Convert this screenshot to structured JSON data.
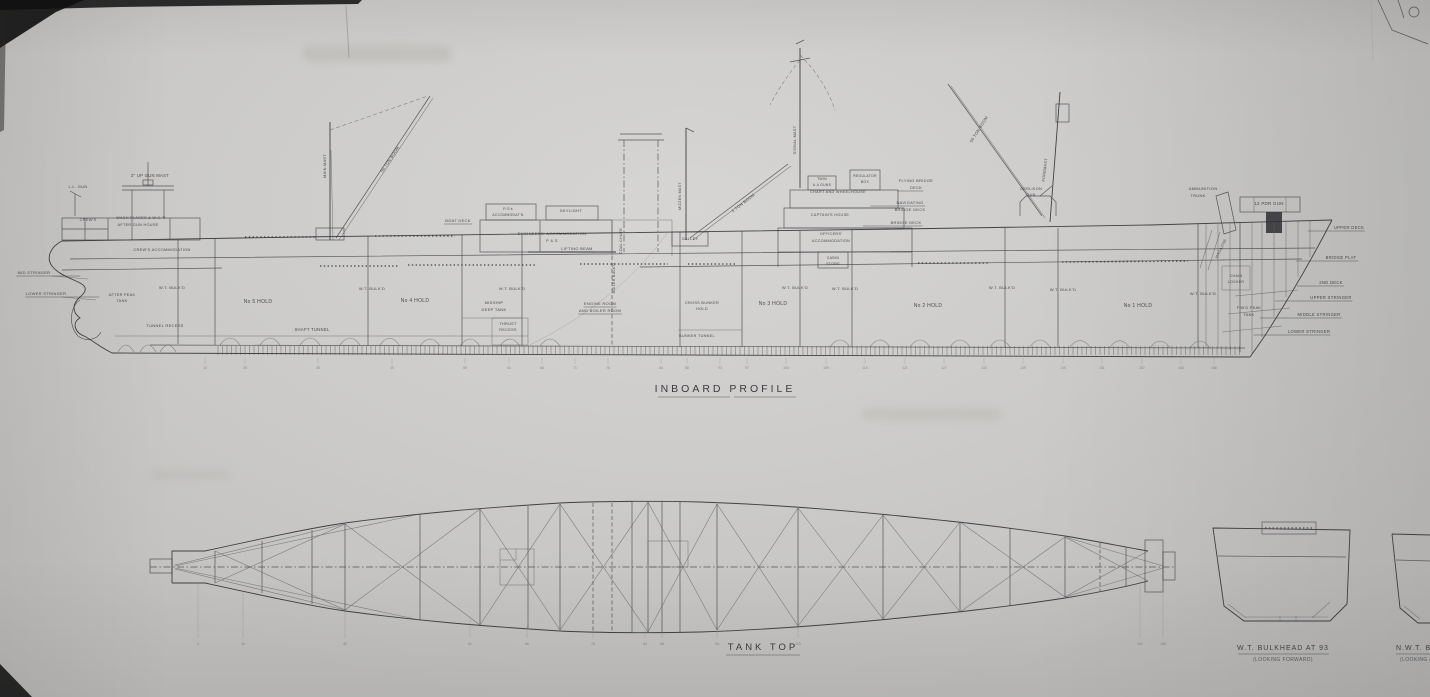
{
  "drawing": {
    "profile_title": "INBOARD PROFILE",
    "tank_top_title": "TANK TOP",
    "bulkhead1_caption": "W.T. BULKHEAD AT 93",
    "bulkhead1_sub": "(LOOKING FORWARD)",
    "bulkhead2_caption": "N.W.T. BULKHEAD",
    "bulkhead2_sub": "(LOOKING FORWARD)"
  },
  "colors": {
    "paper": "#c9c8c5",
    "ink": "#34343a",
    "ink_faint": "#55555a"
  },
  "labels": [
    {
      "n": "ll-gun",
      "t": "L.L. GUN",
      "x": 78,
      "y": 188,
      "s": 4
    },
    {
      "n": "up-gun-mast",
      "t": "2\" UP GUN MAST",
      "x": 150,
      "y": 177,
      "s": 4.2
    },
    {
      "n": "crews",
      "t": "CREW'S",
      "x": 88,
      "y": 221,
      "s": 3.8
    },
    {
      "n": "wash-places",
      "t": "WASH PLACES & W.C.'S",
      "x": 141,
      "y": 219,
      "s": 3.8
    },
    {
      "n": "after-gun-house",
      "t": "AFTER GUN HOUSE",
      "x": 138,
      "y": 226,
      "s": 3.8
    },
    {
      "n": "crews-accommodation",
      "t": "CREW'S ACCOMMODATION",
      "x": 162,
      "y": 251,
      "s": 3.9
    },
    {
      "n": "mid-stringer-aft",
      "t": "MID STRINGER",
      "x": 34,
      "y": 274,
      "s": 4,
      "ul": true,
      "lead": "right"
    },
    {
      "n": "lower-stringer-aft",
      "t": "LOWER STRINGER",
      "x": 46,
      "y": 295,
      "s": 4,
      "ul": true,
      "lead": "right"
    },
    {
      "n": "after-peak-tank-1",
      "t": "AFTER PEAK",
      "x": 122,
      "y": 296,
      "s": 3.8
    },
    {
      "n": "after-peak-tank-2",
      "t": "TANK",
      "x": 122,
      "y": 302,
      "s": 3.8
    },
    {
      "n": "tunnel-recess",
      "t": "TUNNEL RECESS",
      "x": 165,
      "y": 327,
      "s": 4
    },
    {
      "n": "wt-bulkd-0",
      "t": "W.T. BULK'D",
      "x": 172,
      "y": 289,
      "s": 4
    },
    {
      "n": "no5-hold",
      "t": "No 5 HOLD",
      "x": 258,
      "y": 303,
      "s": 5
    },
    {
      "n": "shaft-tunnel",
      "t": "SHAFT TUNNEL",
      "x": 312,
      "y": 331,
      "s": 4.2
    },
    {
      "n": "wt-bulkd-1",
      "t": "W.T. BULK'D",
      "x": 372,
      "y": 290,
      "s": 4
    },
    {
      "n": "no4-hold",
      "t": "No 4 HOLD",
      "x": 415,
      "y": 302,
      "s": 5
    },
    {
      "n": "wt-bulkd-2",
      "t": "W.T. BULK'D",
      "x": 512,
      "y": 290,
      "s": 4
    },
    {
      "n": "midship-deep-tank-1",
      "t": "MIDSHIP",
      "x": 494,
      "y": 304,
      "s": 4
    },
    {
      "n": "midship-deep-tank-2",
      "t": "DEEP TANK",
      "x": 494,
      "y": 311,
      "s": 4
    },
    {
      "n": "thrust-recess-1",
      "t": "THRUST",
      "x": 508,
      "y": 325,
      "s": 3.8
    },
    {
      "n": "thrust-recess-2",
      "t": "RECESS",
      "x": 508,
      "y": 331,
      "s": 3.8
    },
    {
      "n": "boat-deck",
      "t": "BOAT DECK",
      "x": 458,
      "y": 222,
      "s": 4,
      "ul": true
    },
    {
      "n": "pos-accommodation-1",
      "t": "P.O's",
      "x": 508,
      "y": 210,
      "s": 3.6
    },
    {
      "n": "pos-accommodation-2",
      "t": "ACCOMMODAT'N",
      "x": 508,
      "y": 216,
      "s": 3.4
    },
    {
      "n": "skylight",
      "t": "SKYLIGHT",
      "x": 571,
      "y": 212,
      "s": 4
    },
    {
      "n": "engineers-accommodation-1",
      "t": "ENGINEERS' ACCOMMODATION",
      "x": 552,
      "y": 235,
      "s": 4
    },
    {
      "n": "engineers-accommodation-2",
      "t": "P & S",
      "x": 552,
      "y": 242,
      "s": 4
    },
    {
      "n": "lifting-beam",
      "t": "LIFTING BEAM",
      "x": 577,
      "y": 250,
      "s": 4,
      "ul": true
    },
    {
      "n": "coal-chute",
      "t": "COAL CHUTE",
      "x": 622,
      "y": 241,
      "s": 3.6,
      "r": -90
    },
    {
      "n": "boiler-bulkd",
      "t": "BOILER BULK'D",
      "x": 615,
      "y": 278,
      "s": 3.6,
      "r": -90
    },
    {
      "n": "engine-boiler-room-1",
      "t": "ENGINE ROOM",
      "x": 600,
      "y": 305,
      "s": 4,
      "ul": true
    },
    {
      "n": "engine-boiler-room-2",
      "t": "AND BOILER ROOM",
      "x": 600,
      "y": 312,
      "s": 4,
      "ul": true
    },
    {
      "n": "bunker-tunnel",
      "t": "BUNKER TUNNEL",
      "x": 697,
      "y": 337,
      "s": 3.8
    },
    {
      "n": "cross-bunker-hold-1",
      "t": "CROSS BUNKER",
      "x": 702,
      "y": 304,
      "s": 3.8
    },
    {
      "n": "cross-bunker-hold-2",
      "t": "HOLD",
      "x": 702,
      "y": 310,
      "s": 3.8
    },
    {
      "n": "galley",
      "t": "GALLEY",
      "x": 690,
      "y": 240,
      "s": 3.8
    },
    {
      "n": "mizzen-mast",
      "t": "MIZZEN MAST",
      "x": 681,
      "y": 196,
      "s": 3.6,
      "r": -90
    },
    {
      "n": "five-ton-boom",
      "t": "5 TON BOOM",
      "x": 744,
      "y": 204,
      "s": 4,
      "r": -38
    },
    {
      "n": "signal-mast",
      "t": "SIGNAL MAST",
      "x": 796,
      "y": 140,
      "s": 3.8,
      "r": -90
    },
    {
      "n": "twin-aa-guns-1",
      "t": "TWIN",
      "x": 822,
      "y": 180,
      "s": 3.4
    },
    {
      "n": "twin-aa-guns-2",
      "t": "A.A GUNS",
      "x": 822,
      "y": 186,
      "s": 3.4
    },
    {
      "n": "regulator-box-1",
      "t": "REGULATOR",
      "x": 865,
      "y": 177,
      "s": 3.4
    },
    {
      "n": "regulator-box-2",
      "t": "BOX",
      "x": 865,
      "y": 183,
      "s": 3.4
    },
    {
      "n": "flying-bridge-deck-1",
      "t": "FLYING BRIDGE",
      "x": 916,
      "y": 182,
      "s": 4
    },
    {
      "n": "flying-bridge-deck-2",
      "t": "DECK",
      "x": 916,
      "y": 189,
      "s": 4,
      "ul": true,
      "lead": "left"
    },
    {
      "n": "chart-wheelhouse",
      "t": "CHART AND WHEELHOUSE",
      "x": 838,
      "y": 193,
      "s": 3.8
    },
    {
      "n": "navigating-bridge-deck-1",
      "t": "NAVIGATING",
      "x": 910,
      "y": 204,
      "s": 4,
      "ul": true,
      "lead": "left"
    },
    {
      "n": "navigating-bridge-deck-2",
      "t": "BRIDGE DECK",
      "x": 910,
      "y": 211,
      "s": 4
    },
    {
      "n": "captains-house",
      "t": "CAPTAIN'S HOUSE",
      "x": 830,
      "y": 216,
      "s": 3.8
    },
    {
      "n": "bridge-deck",
      "t": "BRIDGE DECK",
      "x": 906,
      "y": 224,
      "s": 4,
      "ul": true,
      "lead": "left"
    },
    {
      "n": "officers-accommodation-1",
      "t": "OFFICERS'",
      "x": 831,
      "y": 235,
      "s": 3.8
    },
    {
      "n": "officers-accommodation-2",
      "t": "ACCOMMODATION",
      "x": 831,
      "y": 242,
      "s": 3.8
    },
    {
      "n": "cabin-store-1",
      "t": "CABIN",
      "x": 833,
      "y": 259,
      "s": 3.6
    },
    {
      "n": "cabin-store-2",
      "t": "STORE",
      "x": 833,
      "y": 265,
      "s": 3.6
    },
    {
      "n": "no3-hold",
      "t": "No 3 HOLD",
      "x": 773,
      "y": 305,
      "s": 5
    },
    {
      "n": "wt-bulkd-3",
      "t": "W.T. BULK'D",
      "x": 795,
      "y": 289,
      "s": 4
    },
    {
      "n": "wt-bulkd-4",
      "t": "W.T. BULK'D",
      "x": 845,
      "y": 290,
      "s": 4
    },
    {
      "n": "no2-hold",
      "t": "No 2 HOLD",
      "x": 928,
      "y": 307,
      "s": 5
    },
    {
      "n": "wt-bulkd-5",
      "t": "W.T. BULK'D",
      "x": 1002,
      "y": 289,
      "s": 4
    },
    {
      "n": "wt-bulkd-6",
      "t": "W.T. BULK'D",
      "x": 1063,
      "y": 291,
      "s": 4
    },
    {
      "n": "no1-hold",
      "t": "No 1 HOLD",
      "x": 1138,
      "y": 307,
      "s": 5
    },
    {
      "n": "wt-bulkd-7",
      "t": "W.T. BULK'D",
      "x": 1203,
      "y": 295,
      "s": 4
    },
    {
      "n": "oerlikon-gun-1",
      "t": "OERLIKON",
      "x": 1031,
      "y": 190,
      "s": 3.8
    },
    {
      "n": "oerlikon-gun-2",
      "t": "GUN",
      "x": 1031,
      "y": 196,
      "s": 3.8
    },
    {
      "n": "foremast",
      "t": "FOREMAST",
      "x": 1046,
      "y": 170,
      "s": 3.8,
      "r": -83
    },
    {
      "n": "fifty-ton-boom-main",
      "t": "50 TON BOOM",
      "x": 391,
      "y": 160,
      "s": 4,
      "r": -56
    },
    {
      "n": "fifty-ton-boom-fore",
      "t": "50 TON BOOM",
      "x": 980,
      "y": 130,
      "s": 4,
      "r": -58
    },
    {
      "n": "ammunition-trunk-1",
      "t": "AMMUNITION",
      "x": 1203,
      "y": 190,
      "s": 4
    },
    {
      "n": "ammunition-trunk-2",
      "t": "TRUNK",
      "x": 1198,
      "y": 197,
      "s": 4
    },
    {
      "n": "twelve-pdr-gun",
      "t": "12 PDR GUN",
      "x": 1269,
      "y": 205,
      "s": 4.4
    },
    {
      "n": "magazine",
      "t": "MAGAZINE",
      "x": 1222,
      "y": 249,
      "s": 3.6,
      "r": -64
    },
    {
      "n": "chain-locker-1",
      "t": "CHAIN",
      "x": 1236,
      "y": 277,
      "s": 3.6
    },
    {
      "n": "chain-locker-2",
      "t": "LOCKER",
      "x": 1236,
      "y": 283,
      "s": 3.6
    },
    {
      "n": "fwd-peak-tank-1",
      "t": "F'W'D PEAK",
      "x": 1249,
      "y": 309,
      "s": 3.8
    },
    {
      "n": "fwd-peak-tank-2",
      "t": "TANK",
      "x": 1249,
      "y": 316,
      "s": 3.8
    },
    {
      "n": "upper-deck-bow",
      "t": "UPPER DECK",
      "x": 1349,
      "y": 229,
      "s": 4.2,
      "ul": true,
      "lead": "left"
    },
    {
      "n": "bridge-plat",
      "t": "BRIDGE PLAT",
      "x": 1341,
      "y": 259,
      "s": 4.2,
      "ul": true,
      "lead": "left"
    },
    {
      "n": "second-deck",
      "t": "2ND DECK",
      "x": 1331,
      "y": 284,
      "s": 4.2,
      "ul": true,
      "lead": "left"
    },
    {
      "n": "upper-stringer",
      "t": "UPPER STRINGER",
      "x": 1331,
      "y": 299,
      "s": 4.2,
      "ul": true,
      "lead": "left"
    },
    {
      "n": "middle-stringer",
      "t": "MIDDLE STRINGER",
      "x": 1319,
      "y": 316,
      "s": 4.2,
      "ul": true,
      "lead": "left"
    },
    {
      "n": "lower-stringer-bow",
      "t": "LOWER STRINGER",
      "x": 1309,
      "y": 333,
      "s": 4.2,
      "ul": true,
      "lead": "left"
    },
    {
      "n": "main-mast",
      "t": "MAIN MAST",
      "x": 326,
      "y": 166,
      "s": 3.8,
      "r": -90
    }
  ],
  "frame_numbers_profile": [
    {
      "t": "15",
      "x": 205
    },
    {
      "t": "25",
      "x": 245
    },
    {
      "t": "35",
      "x": 318
    },
    {
      "t": "45",
      "x": 392
    },
    {
      "t": "55",
      "x": 465
    },
    {
      "t": "61",
      "x": 509
    },
    {
      "t": "66",
      "x": 542
    },
    {
      "t": "71",
      "x": 575
    },
    {
      "t": "76",
      "x": 608
    },
    {
      "t": "84",
      "x": 661
    },
    {
      "t": "88",
      "x": 687
    },
    {
      "t": "93",
      "x": 720
    },
    {
      "t": "97",
      "x": 747
    },
    {
      "t": "103",
      "x": 786
    },
    {
      "t": "109",
      "x": 826
    },
    {
      "t": "115",
      "x": 865
    },
    {
      "t": "121",
      "x": 905
    },
    {
      "t": "127",
      "x": 944
    },
    {
      "t": "133",
      "x": 984
    },
    {
      "t": "139",
      "x": 1023
    },
    {
      "t": "145",
      "x": 1063
    },
    {
      "t": "151",
      "x": 1102
    },
    {
      "t": "157",
      "x": 1142
    },
    {
      "t": "163",
      "x": 1181
    },
    {
      "t": "168",
      "x": 1214
    }
  ],
  "frame_numbers_tank": [
    {
      "t": "4",
      "x": 198,
      "y1": 583
    },
    {
      "t": "16",
      "x": 243,
      "y1": 592
    },
    {
      "t": "40",
      "x": 345,
      "y1": 610
    },
    {
      "t": "61",
      "x": 470,
      "y1": 620
    },
    {
      "t": "66",
      "x": 527,
      "y1": 626
    },
    {
      "t": "76",
      "x": 593,
      "y1": 630
    },
    {
      "t": "84",
      "x": 645,
      "y1": 631
    },
    {
      "t": "88",
      "x": 662,
      "y1": 631
    },
    {
      "t": "93",
      "x": 717,
      "y1": 629
    },
    {
      "t": "103",
      "x": 798,
      "y1": 625
    },
    {
      "t": "162",
      "x": 1140,
      "y1": 585
    },
    {
      "t": "168",
      "x": 1163,
      "y1": 580
    }
  ]
}
